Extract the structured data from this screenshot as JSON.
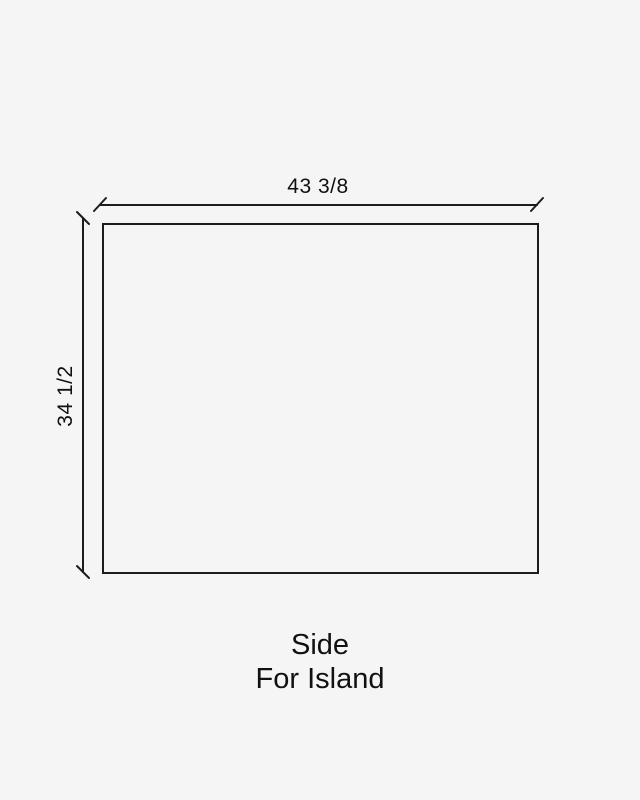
{
  "diagram": {
    "type": "dimensioned-drawing",
    "shape": "rectangle",
    "width_dimension": "43 3/8",
    "height_dimension": "34 1/2",
    "caption_line1": "Side",
    "caption_line2": "For Island",
    "colors": {
      "background": "#f5f5f5",
      "line": "#1c1c1c",
      "text": "#111111"
    }
  }
}
